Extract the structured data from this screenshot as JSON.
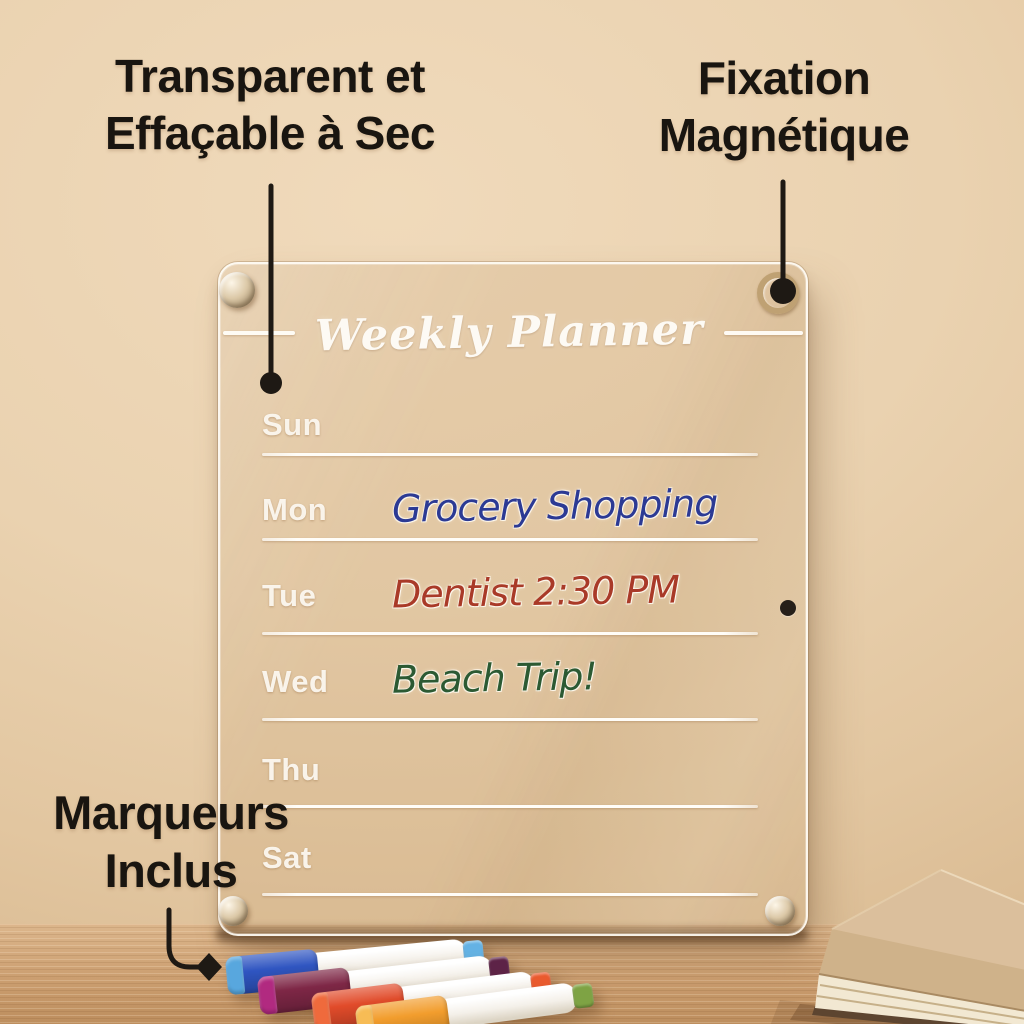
{
  "callouts": {
    "transparent": {
      "line1": "Transparent et",
      "line2": "Effaçable à Sec"
    },
    "magnetic": {
      "line1": "Fixation",
      "line2": "Magnétique"
    },
    "markers_included": {
      "line1": "Marqueurs",
      "line2": "Inclus"
    }
  },
  "board": {
    "title": "Weekly Planner",
    "rows": [
      {
        "day": "Sun",
        "entry": "",
        "entry_color": ""
      },
      {
        "day": "Mon",
        "entry": "Grocery Shopping",
        "entry_color": "#2c3a94"
      },
      {
        "day": "Tue",
        "entry": "Dentist 2:30 PM",
        "entry_color": "#a93a28"
      },
      {
        "day": "Wed",
        "entry": "Beach Trip!",
        "entry_color": "#2c5a33"
      },
      {
        "day": "Thu",
        "entry": "",
        "entry_color": ""
      },
      {
        "day": "Sat",
        "entry": "",
        "entry_color": ""
      }
    ]
  },
  "markers": [
    {
      "name": "blue",
      "cap": "#2f55c1",
      "nose": "#58a7de",
      "tip": "#64b2e4"
    },
    {
      "name": "plum",
      "cap": "#7e2746",
      "nose": "#b12a80",
      "tip": "#5d2347"
    },
    {
      "name": "red",
      "cap": "#e14b2a",
      "nose": "#ef6a3c",
      "tip": "#ea5a2e"
    },
    {
      "name": "orange",
      "cap": "#f29d2d",
      "nose": "#f7bc55",
      "tip": "#7ea344"
    }
  ],
  "colors": {
    "wall": "#e9d1af",
    "desk_wood": "#d3a878",
    "callout_text": "#191510",
    "board_line": "#fffdf8",
    "screw_metal": "#cdbb9a",
    "book_cover": "#dbbf9c",
    "book_pages": "#f2e8d2"
  }
}
